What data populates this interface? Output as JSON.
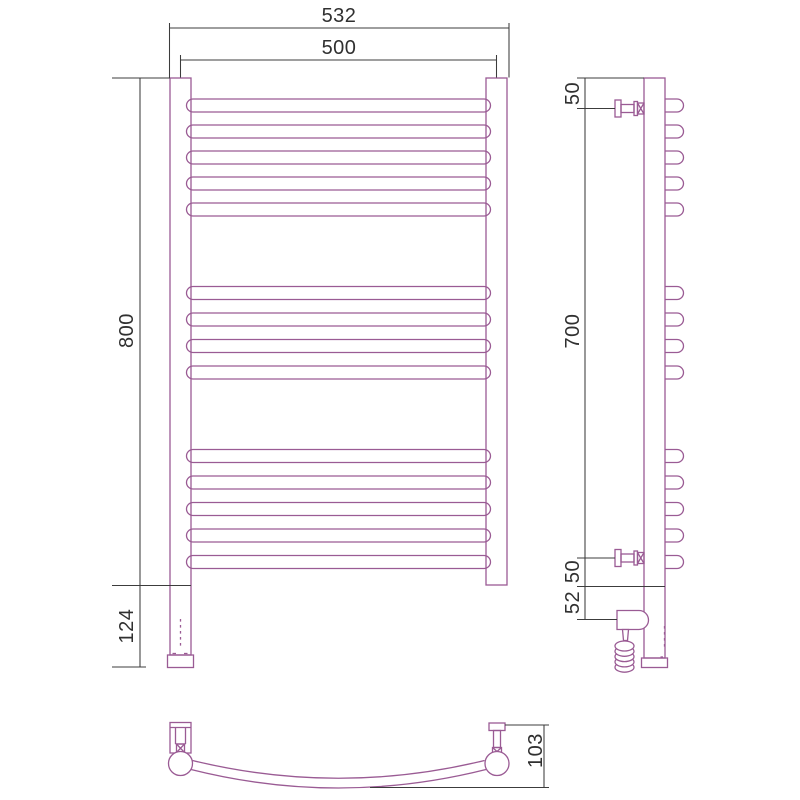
{
  "colors": {
    "product_line": "#9a5b94",
    "dimension_line": "#3c3c3c",
    "text": "#303030",
    "background": "#ffffff"
  },
  "front_view": {
    "dim_overall_width": "532",
    "dim_mount_width": "500",
    "dim_height": "800",
    "dim_bottom_extension": "124",
    "bar_count": 14,
    "bar_groups": [
      5,
      4,
      5
    ],
    "bar_x": 186.5,
    "bar_width": 304,
    "bar_height": 13,
    "bar_center_y": [
      105.5,
      131.5,
      157.5,
      183.5,
      209.5,
      293,
      319.5,
      346,
      372.5,
      456,
      482.5,
      509,
      535.5,
      562
    ]
  },
  "side_view": {
    "dim_top_offset": "50",
    "dim_bracket_span": "700",
    "dim_bottom_offset": "50",
    "dim_heater_offset": "52",
    "stub_count": 14,
    "stub_x": 665,
    "stub_straight": 12,
    "stub_radius": 6.5,
    "stub_center_y": [
      105.5,
      131.5,
      157.5,
      183.5,
      209.5,
      293,
      319.5,
      346,
      372.5,
      456,
      482.5,
      509,
      535.5,
      562
    ]
  },
  "top_view": {
    "dim_depth": "103"
  }
}
